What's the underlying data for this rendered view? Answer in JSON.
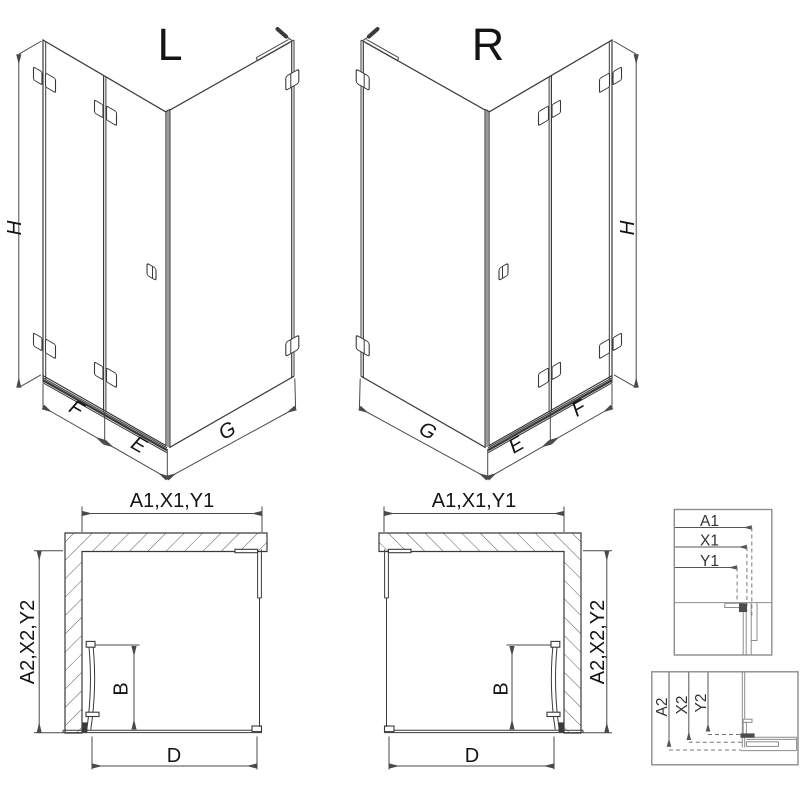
{
  "drawing": {
    "iso_left": {
      "variant": "L",
      "height": "H",
      "fixed_panel": "F",
      "door_panel": "E",
      "side_panel": "G"
    },
    "iso_right": {
      "variant": "R",
      "height": "H",
      "fixed_panel": "F",
      "door_panel": "E",
      "side_panel": "G"
    },
    "plan_left": {
      "width_dims": "A1,X1,Y1",
      "depth_dims": "A2,X2,Y2",
      "door_width": "B",
      "opening_width": "D"
    },
    "plan_right": {
      "width_dims": "A1,X1,Y1",
      "depth_dims": "A2,X2,Y2",
      "door_width": "B",
      "opening_width": "D"
    },
    "detail_width": {
      "a1": "A1",
      "x1": "X1",
      "y1": "Y1"
    },
    "detail_depth": {
      "a2": "A2",
      "x2": "X2",
      "y2": "Y2"
    },
    "colors": {
      "line": "#3a3a3a",
      "dimension": "#4a4a4a",
      "detail": "#8c8c8c",
      "background": "#ffffff"
    }
  }
}
